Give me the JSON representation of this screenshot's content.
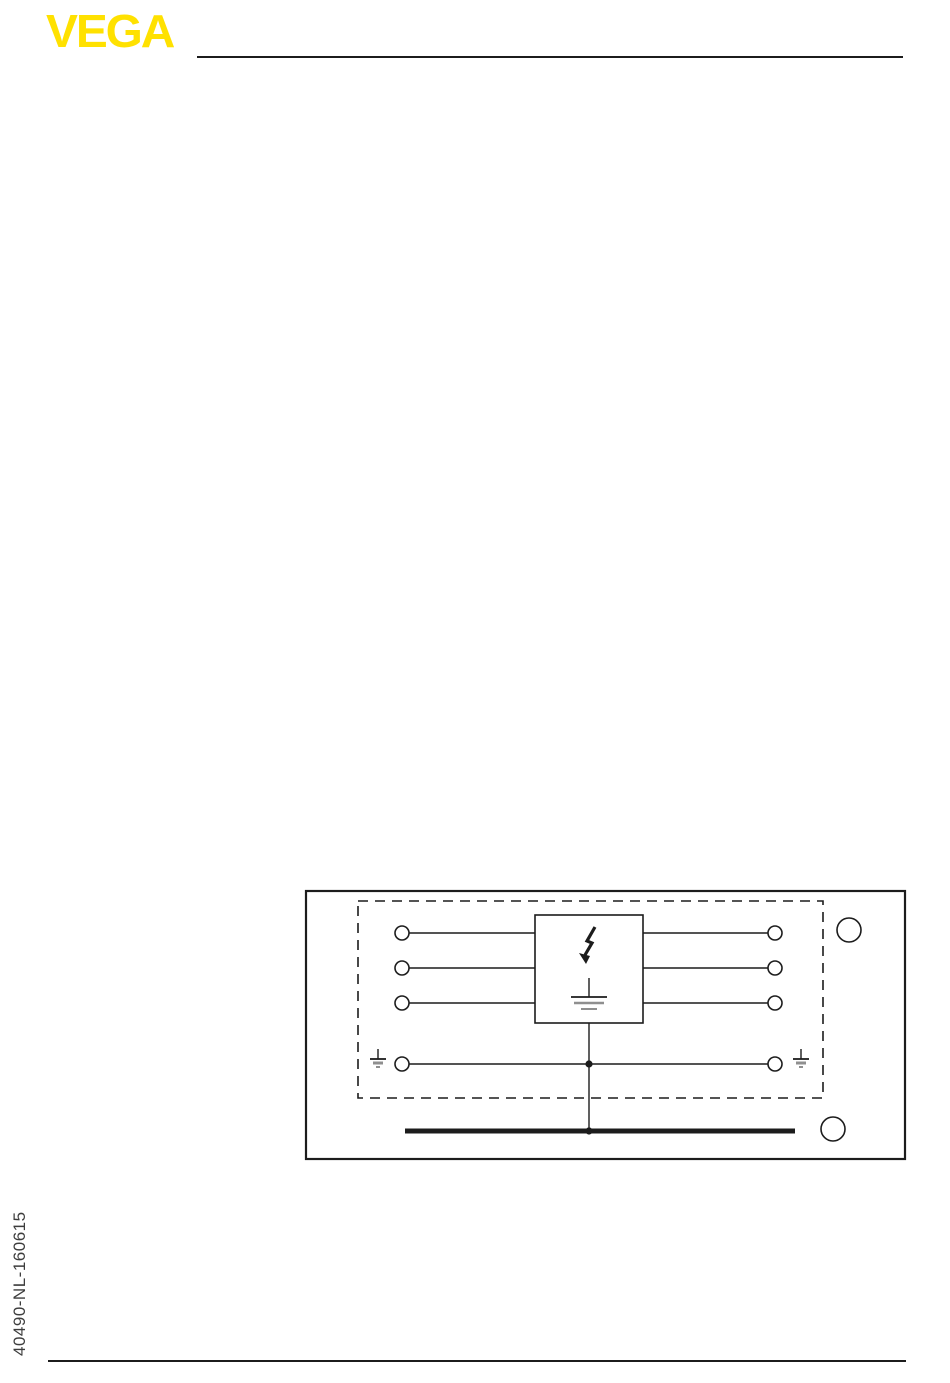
{
  "page": {
    "width": 950,
    "height": 1383,
    "background": "#ffffff"
  },
  "colors": {
    "accent": "#ffe100",
    "line": "#1c1c1c",
    "gray": "#8f8f8f",
    "text": "#3d3d3d",
    "bg": "#ffffff"
  },
  "header": {
    "logo_text": "VEGA"
  },
  "left_margin": {
    "doc_number": "40490-NL-160615"
  },
  "figure": {
    "type": "wiring-diagram",
    "description": "Overvoltage/surge arrester block with three signal feed-through wires, a common earth wire with terminals on both sides, earth symbols inside a dashed shielding zone, and a thick equipotential ground bus bar below; two empty callout circles at top-right and bottom-right of the solid frame.",
    "terminals_left": 4,
    "terminals_right": 4,
    "callout_top_label": "",
    "callout_bottom_label": ""
  }
}
